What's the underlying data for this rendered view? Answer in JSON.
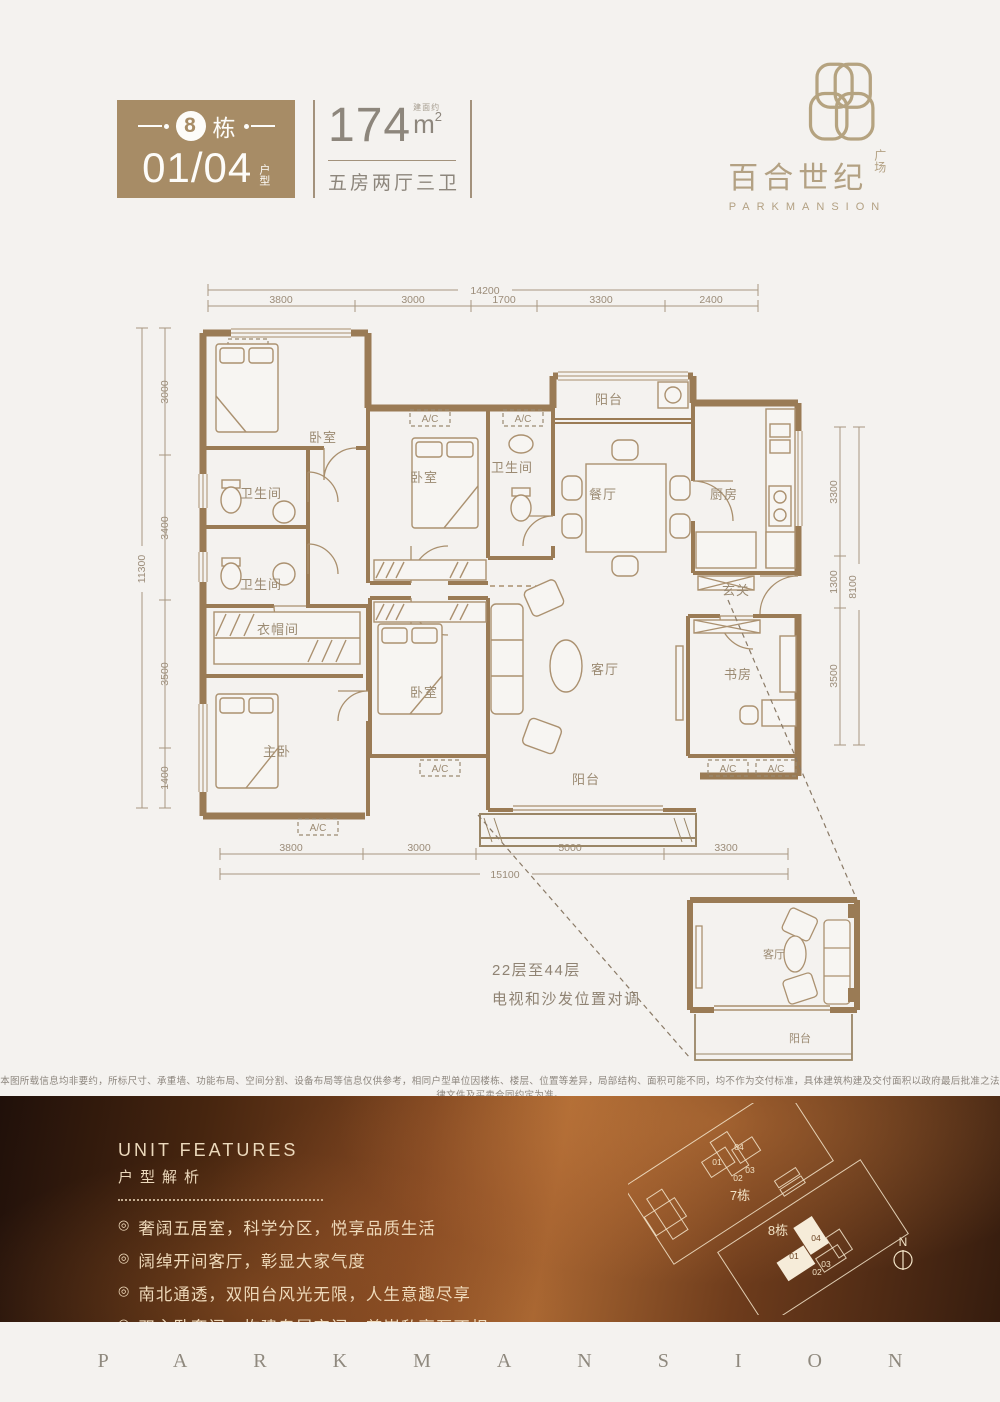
{
  "header": {
    "badge": {
      "building_number": "8",
      "building_suffix": "栋",
      "unit_numbers": "01/04",
      "unit_type_label": "户型"
    },
    "area": {
      "value": "174",
      "approx_label": "建面约",
      "unit_main": "m",
      "unit_sup": "2",
      "layout_desc": "五房两厅三卫"
    },
    "logo": {
      "brand_cn": "百合世纪",
      "brand_suffix": "广场",
      "brand_en": "PARKMANSION"
    }
  },
  "floorplan": {
    "ac_label": "A/C",
    "rooms": {
      "bedroom_top_left": "卧室",
      "bath_upper": "卫生间",
      "bath_lower": "卫生间",
      "bedroom_middle": "卧室",
      "bath_small": "卫生间",
      "balcony_top": "阳台",
      "dining": "餐厅",
      "kitchen": "厨房",
      "foyer": "玄关",
      "cloakroom": "衣帽间",
      "master_bedroom": "主卧",
      "bedroom_bottom": "卧室",
      "living": "客厅",
      "study": "书房",
      "balcony_bottom": "阳台"
    },
    "dims_top": {
      "overall": "14200",
      "segments": [
        "3800",
        "3000",
        "1700",
        "3300",
        "2400"
      ]
    },
    "dims_bottom": {
      "overall": "15100",
      "segments": [
        "3800",
        "3000",
        "5000",
        "3300"
      ]
    },
    "dims_left": {
      "overall": "11300",
      "segments": [
        "3000",
        "3400",
        "3500",
        "1400"
      ]
    },
    "dims_right": {
      "overall": "8100",
      "segments": [
        "3300",
        "1300",
        "3500"
      ]
    },
    "inset": {
      "note_line1": "22层至44层",
      "note_line2": "电视和沙发位置对调",
      "living": "客厅",
      "balcony": "阳台"
    }
  },
  "disclaimer": "本图所载信息均非要约，所标尺寸、承重墙、功能布局、空间分割、设备布局等信息仅供参考，相同户型单位因楼栋、楼层、位置等差异，局部结构、面积可能不同，均不作为交付标准，具体建筑构建及交付面积以政府最后批准之法律文件及买卖合同约定为准。",
  "features": {
    "title_en": "UNIT FEATURES",
    "title_cn": "户型解析",
    "bullet_icon": "◎",
    "bullets": [
      "奢阔五居室，科学分区，悦享品质生活",
      "阔绰开间客厅，彰显大家气度",
      "南北通透，双阳台风光无限，人生意趣尽享",
      "双主卧套间，构建专属空间，尊崇私享互不相扰"
    ]
  },
  "siteplan": {
    "building7_label": "7栋",
    "building8_label": "8栋",
    "units": [
      "01",
      "02",
      "03",
      "04"
    ],
    "compass_label": "N"
  },
  "footer": {
    "brand": "PARKMANSION"
  }
}
